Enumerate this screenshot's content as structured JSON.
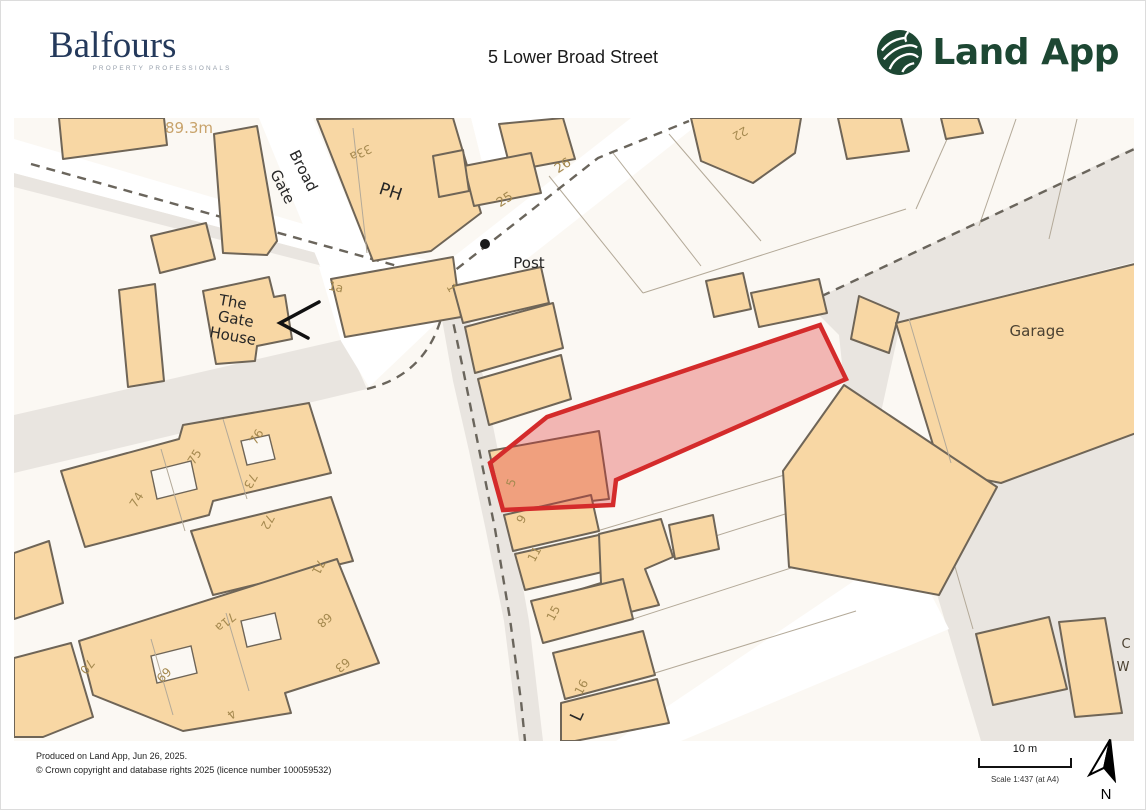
{
  "header": {
    "brand": {
      "name": "Balfours",
      "tagline": "PROPERTY PROFESSIONALS"
    },
    "title": "5 Lower Broad Street",
    "landapp": {
      "label": "Land App"
    }
  },
  "footer": {
    "produced_line": "Produced on Land App, Jun 26, 2025.",
    "copyright_line": "© Crown copyright and database rights 2025 (licence number 100059532)",
    "scale": {
      "bar_label": "10 m",
      "ratio_text": "Scale 1:437 (at A4)"
    },
    "north_label": "N"
  },
  "map": {
    "colors": {
      "parcel_bg": "#FBF8F3",
      "road": "#FFFFFF",
      "surface_gray": "#E9E5E0",
      "building_fill": "#F8D7A4",
      "building_outline": "#6F6557",
      "boundary_dash": "#6A655C",
      "highlight_fill": "rgba(224,49,49,0.33)",
      "highlight_stroke": "#D42B2B",
      "black": "#262626",
      "tan": "#A5894F",
      "brown": "#4C4232",
      "height": "#C8A36B"
    },
    "labels": [
      [
        "89.3m",
        188,
        132,
        0,
        15,
        "height"
      ],
      [
        "Broad",
        298,
        172,
        63,
        15,
        "black"
      ],
      [
        "Gate",
        277,
        188,
        63,
        15,
        "black"
      ],
      [
        "PH",
        388,
        196,
        18,
        17,
        "black"
      ],
      [
        "33a",
        358,
        148,
        155,
        12,
        "tan"
      ],
      [
        "25",
        506,
        202,
        -33,
        13,
        "tan"
      ],
      [
        "26",
        564,
        168,
        -33,
        13,
        "tan"
      ],
      [
        "22",
        737,
        129,
        150,
        12,
        "tan"
      ],
      [
        "Post",
        528,
        267,
        0,
        15,
        "black"
      ],
      [
        "1",
        447,
        289,
        60,
        12,
        "tan"
      ],
      [
        "1a",
        334,
        290,
        12,
        12,
        "tan"
      ],
      [
        "The",
        231,
        306,
        10,
        15,
        "black"
      ],
      [
        "Gate",
        234,
        323,
        10,
        15,
        "black"
      ],
      [
        "House",
        231,
        340,
        10,
        15,
        "black"
      ],
      [
        "Garage",
        1036,
        335,
        0,
        15,
        "brown"
      ],
      [
        "5",
        514,
        483,
        -70,
        12,
        "tan"
      ],
      [
        "9",
        524,
        520,
        -62,
        12,
        "tan"
      ],
      [
        "11",
        537,
        555,
        -62,
        12,
        "tan"
      ],
      [
        "15",
        556,
        614,
        -62,
        12,
        "tan"
      ],
      [
        "16",
        584,
        688,
        -62,
        12,
        "tan"
      ],
      [
        "L",
        581,
        717,
        -65,
        17,
        "black"
      ],
      [
        "76",
        259,
        438,
        -58,
        12,
        "tan"
      ],
      [
        "75",
        197,
        458,
        -58,
        12,
        "tan"
      ],
      [
        "73",
        246,
        478,
        118,
        12,
        "tan"
      ],
      [
        "74",
        139,
        501,
        -58,
        12,
        "tan"
      ],
      [
        "72",
        263,
        519,
        118,
        12,
        "tan"
      ],
      [
        "71",
        314,
        564,
        118,
        12,
        "tan"
      ],
      [
        "71a",
        222,
        618,
        140,
        12,
        "tan"
      ],
      [
        "68",
        321,
        616,
        140,
        12,
        "tan"
      ],
      [
        "63",
        339,
        661,
        140,
        12,
        "tan"
      ],
      [
        "70",
        83,
        663,
        128,
        12,
        "tan"
      ],
      [
        "69",
        166,
        677,
        -45,
        12,
        "tan"
      ],
      [
        "4",
        228,
        710,
        140,
        12,
        "tan"
      ],
      [
        "C",
        1125,
        647,
        0,
        13,
        "brown"
      ],
      [
        "W",
        1122,
        670,
        0,
        13,
        "brown"
      ]
    ]
  }
}
